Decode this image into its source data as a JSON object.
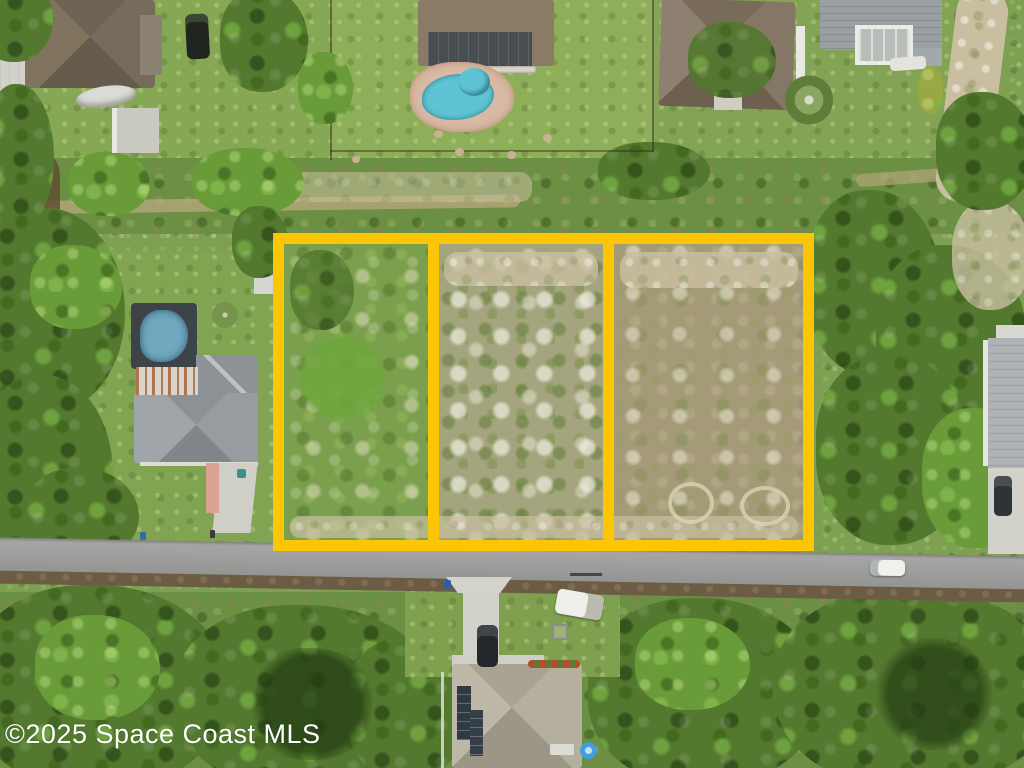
{
  "watermark": {
    "text": "©2025 Space Coast MLS"
  },
  "scene": {
    "kind": "aerial-drone-photo-residential-vacant-land",
    "lot_outline_count": 3,
    "lots": [
      {
        "id": 1,
        "position": "left",
        "ground": "grassy-with-sand-patches"
      },
      {
        "id": 2,
        "position": "center",
        "ground": "cleared-sandy"
      },
      {
        "id": 3,
        "position": "right",
        "ground": "dry-grass-with-tire-rings"
      }
    ],
    "features": [
      "street running horizontally below outlined lots",
      "house with kidney-shaped swimming pool top center",
      "house with screened blue pool left middle",
      "house with solar panels bottom center",
      "white pickup truck parked on bottom lawn",
      "white car driving on road right side"
    ]
  },
  "colors": {
    "lot_outline": "#fcc506",
    "road": "#a0a0a0",
    "pool_water": "#5ec4d4",
    "screened_pool_water": "#6fa8bf",
    "spa_water": "#3f9fdc",
    "grass": "#7da053",
    "trees": "#53792f",
    "sand": "#c9bfa0",
    "watermark_text": "#ffffff"
  }
}
